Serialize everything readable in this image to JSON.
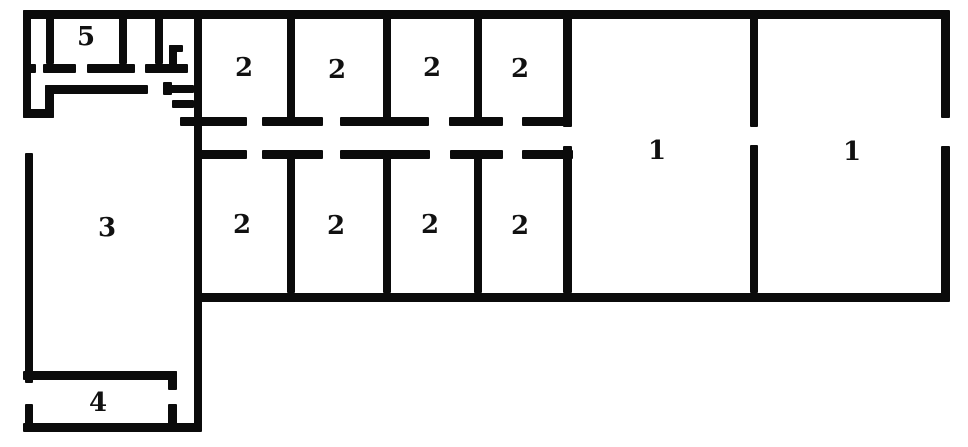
{
  "diagram": {
    "type": "floor-plan",
    "canvas": {
      "width": 968,
      "height": 447,
      "background": "#ffffff"
    },
    "wall_color": "#0b0b0b",
    "label_color": "#111111",
    "rooms": [
      {
        "id": "room-1-left",
        "label": "1",
        "cx": 657,
        "cy": 151
      },
      {
        "id": "room-1-right",
        "label": "1",
        "cx": 852,
        "cy": 152
      },
      {
        "id": "room-2-top-1",
        "label": "2",
        "cx": 244,
        "cy": 68
      },
      {
        "id": "room-2-top-2",
        "label": "2",
        "cx": 337,
        "cy": 70
      },
      {
        "id": "room-2-top-3",
        "label": "2",
        "cx": 432,
        "cy": 68
      },
      {
        "id": "room-2-top-4",
        "label": "2",
        "cx": 520,
        "cy": 69
      },
      {
        "id": "room-2-bottom-1",
        "label": "2",
        "cx": 242,
        "cy": 225
      },
      {
        "id": "room-2-bottom-2",
        "label": "2",
        "cx": 336,
        "cy": 226
      },
      {
        "id": "room-2-bottom-3",
        "label": "2",
        "cx": 430,
        "cy": 225
      },
      {
        "id": "room-2-bottom-4",
        "label": "2",
        "cx": 520,
        "cy": 226
      },
      {
        "id": "room-3",
        "label": "3",
        "cx": 107,
        "cy": 228
      },
      {
        "id": "room-4",
        "label": "4",
        "cx": 98,
        "cy": 403
      },
      {
        "id": "room-5",
        "label": "5",
        "cx": 86,
        "cy": 37
      }
    ],
    "walls": [
      {
        "name": "top-wall",
        "x": 23,
        "y": 10,
        "w": 926,
        "h": 9
      },
      {
        "name": "right-wall-upper",
        "x": 941,
        "y": 10,
        "w": 9,
        "h": 108
      },
      {
        "name": "right-wall-lower",
        "x": 941,
        "y": 146,
        "w": 9,
        "h": 156
      },
      {
        "name": "main-bottom-wall",
        "x": 194,
        "y": 293,
        "w": 755,
        "h": 9
      },
      {
        "name": "main-vertical-wall",
        "x": 194,
        "y": 10,
        "w": 8,
        "h": 422
      },
      {
        "name": "left-wall-upper",
        "x": 23,
        "y": 10,
        "w": 8,
        "h": 108
      },
      {
        "name": "room5-left-partition",
        "x": 46,
        "y": 17,
        "w": 8,
        "h": 47
      },
      {
        "name": "room5-right-partition",
        "x": 119,
        "y": 17,
        "w": 8,
        "h": 47
      },
      {
        "name": "cell-partition",
        "x": 155,
        "y": 17,
        "w": 8,
        "h": 47
      },
      {
        "name": "hook-vertical",
        "x": 169,
        "y": 45,
        "w": 8,
        "h": 24
      },
      {
        "name": "hook-top",
        "x": 169,
        "y": 45,
        "w": 14,
        "h": 7
      },
      {
        "name": "door-wall-seg-a",
        "x": 23,
        "y": 64,
        "w": 13,
        "h": 9
      },
      {
        "name": "door-wall-seg-b",
        "x": 43,
        "y": 64,
        "w": 33,
        "h": 9
      },
      {
        "name": "door-wall-seg-c",
        "x": 87,
        "y": 64,
        "w": 48,
        "h": 9
      },
      {
        "name": "door-wall-seg-d",
        "x": 145,
        "y": 64,
        "w": 43,
        "h": 9
      },
      {
        "name": "inner-wall-horizontal",
        "x": 45,
        "y": 85,
        "w": 103,
        "h": 9
      },
      {
        "name": "inner-wall-upturn",
        "x": 45,
        "y": 85,
        "w": 9,
        "h": 33
      },
      {
        "name": "left-corridor-end",
        "x": 23,
        "y": 109,
        "w": 31,
        "h": 9
      },
      {
        "name": "vestibule-stub-vertical",
        "x": 163,
        "y": 82,
        "w": 9,
        "h": 13
      },
      {
        "name": "vestibule-stub-upper",
        "x": 170,
        "y": 85,
        "w": 24,
        "h": 8
      },
      {
        "name": "vestibule-stub-lower",
        "x": 172,
        "y": 100,
        "w": 22,
        "h": 8
      },
      {
        "name": "corridor-upper-seg-1",
        "x": 180,
        "y": 117,
        "w": 67,
        "h": 9
      },
      {
        "name": "corridor-upper-seg-2",
        "x": 262,
        "y": 117,
        "w": 61,
        "h": 9
      },
      {
        "name": "corridor-upper-seg-3",
        "x": 340,
        "y": 117,
        "w": 89,
        "h": 9
      },
      {
        "name": "corridor-upper-seg-4",
        "x": 449,
        "y": 117,
        "w": 54,
        "h": 9
      },
      {
        "name": "corridor-upper-seg-5",
        "x": 522,
        "y": 117,
        "w": 50,
        "h": 9
      },
      {
        "name": "corridor-lower-seg-1",
        "x": 194,
        "y": 150,
        "w": 53,
        "h": 9
      },
      {
        "name": "corridor-lower-seg-2",
        "x": 262,
        "y": 150,
        "w": 61,
        "h": 9
      },
      {
        "name": "corridor-lower-seg-3",
        "x": 340,
        "y": 150,
        "w": 90,
        "h": 9
      },
      {
        "name": "corridor-lower-seg-4",
        "x": 450,
        "y": 150,
        "w": 53,
        "h": 9
      },
      {
        "name": "corridor-lower-seg-5",
        "x": 522,
        "y": 150,
        "w": 51,
        "h": 9
      },
      {
        "name": "top-row-divider-1",
        "x": 287,
        "y": 17,
        "w": 8,
        "h": 109
      },
      {
        "name": "top-row-divider-2",
        "x": 383,
        "y": 17,
        "w": 8,
        "h": 109
      },
      {
        "name": "top-row-divider-3",
        "x": 474,
        "y": 17,
        "w": 8,
        "h": 109
      },
      {
        "name": "rooms2-right-wall-upper",
        "x": 563,
        "y": 10,
        "w": 9,
        "h": 117
      },
      {
        "name": "bottom-row-divider-1",
        "x": 287,
        "y": 150,
        "w": 8,
        "h": 143
      },
      {
        "name": "bottom-row-divider-2",
        "x": 383,
        "y": 150,
        "w": 8,
        "h": 143
      },
      {
        "name": "bottom-row-divider-3",
        "x": 474,
        "y": 150,
        "w": 8,
        "h": 143
      },
      {
        "name": "rooms2-right-wall-lower",
        "x": 563,
        "y": 146,
        "w": 9,
        "h": 147
      },
      {
        "name": "rooms1-divider-upper",
        "x": 750,
        "y": 13,
        "w": 8,
        "h": 114
      },
      {
        "name": "rooms1-divider-lower",
        "x": 750,
        "y": 145,
        "w": 8,
        "h": 148
      },
      {
        "name": "room3-left-wall",
        "x": 25,
        "y": 153,
        "w": 8,
        "h": 230
      },
      {
        "name": "room4-left-wall",
        "x": 25,
        "y": 404,
        "w": 8,
        "h": 28
      },
      {
        "name": "left-block-bottom-wall",
        "x": 23,
        "y": 423,
        "w": 177,
        "h": 9
      },
      {
        "name": "room4-top-wall",
        "x": 23,
        "y": 371,
        "w": 154,
        "h": 9
      },
      {
        "name": "room4-right-stub-upper",
        "x": 168,
        "y": 371,
        "w": 9,
        "h": 19
      },
      {
        "name": "room4-right-stub-lower",
        "x": 168,
        "y": 404,
        "w": 9,
        "h": 21
      }
    ]
  }
}
